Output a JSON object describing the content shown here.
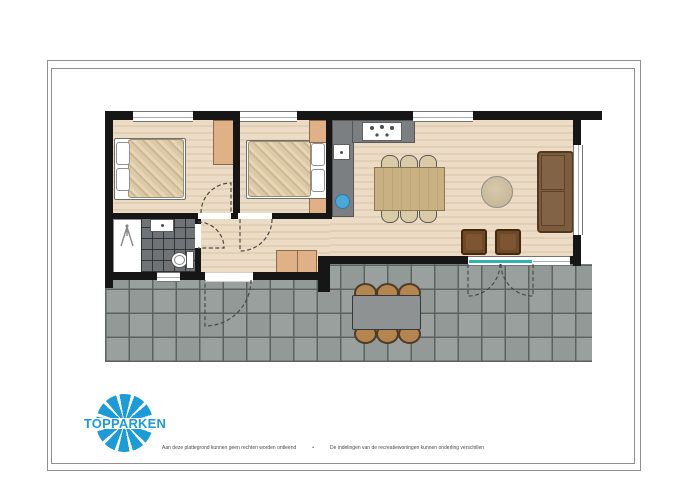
{
  "branding": {
    "logo_text": "TOPPARKEN"
  },
  "footer": {
    "disclaimer_left": "Aan deze plattegrond kunnen geen rechten worden ontleend",
    "separator": "•",
    "disclaimer_right": "De indelingen van de recreatiewoningen kunnen onderling verschillen"
  },
  "colors": {
    "brand-blue": "#1b9cd8",
    "wall": "#161616",
    "wood": "#ecdcc6",
    "wood-stripe": "#e2d0b6",
    "terrace-tile": "#9aa09d",
    "terrace-grout": "#5d625f",
    "bath-tile": "#6f7376",
    "counter": "#7b7f82",
    "furniture-beige": "#e0b086",
    "sofa": "#7b5c3b",
    "armchair": "#6f4a28",
    "table-wood": "#c9b184",
    "outdoor-chair": "#b5854f",
    "outdoor-table": "#8e9292",
    "glass-teal": "#2fb3ad",
    "sink-blue": "#49a8d9"
  },
  "plan": {
    "rooms": [
      "bedroom-1",
      "bedroom-2",
      "bathroom",
      "hallway",
      "kitchen",
      "living-room",
      "terrace"
    ],
    "furniture": [
      "double-bed-1",
      "double-bed-2",
      "wardrobe",
      "nightstand",
      "hall-cabinet",
      "kitchen-hob",
      "kitchen-sink",
      "dining-table-6-chairs",
      "coffee-table",
      "sofa",
      "armchairs",
      "outdoor-table-6-chairs",
      "shower",
      "washbasin",
      "toilet",
      "french-doors"
    ]
  }
}
